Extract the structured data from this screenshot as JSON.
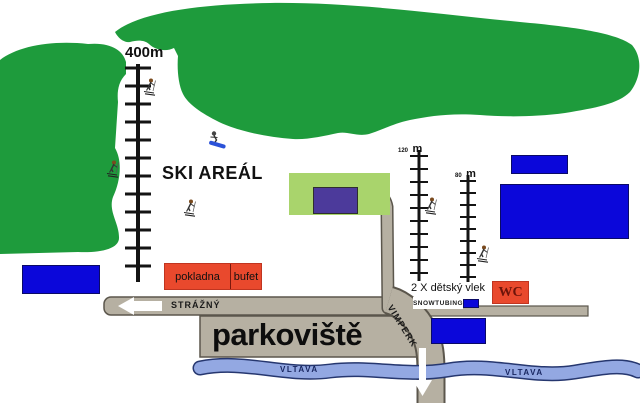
{
  "map_title": "SKI AREÁL",
  "lifts": {
    "main_length": "400m",
    "child1_length": "120",
    "child1_unit": "m",
    "child2_length": "80",
    "child2_unit": "m",
    "children_caption": "2 X dětský vlek",
    "snowtubing_label": "SNOWTUBING"
  },
  "facilities": {
    "ticket_office": "pokladna",
    "buffet": "bufet",
    "wc": "WC"
  },
  "roads": {
    "left_road": "STRÁŽNÝ",
    "right_road": "VIMPERK",
    "parking": "parkoviště"
  },
  "river": {
    "name": "VLTAVA",
    "label_left": "VLTAVA",
    "label_right": "VLTAVA"
  },
  "colors": {
    "forest_green": "#1e9b3c",
    "building_green": "#a9d46c",
    "building_purple": "#4c3a9b",
    "parking_lot_blue": "#0b07da",
    "service_red": "#e9492d",
    "road_gray": "#b6b0a2",
    "river_blue": "#93a8e2"
  }
}
